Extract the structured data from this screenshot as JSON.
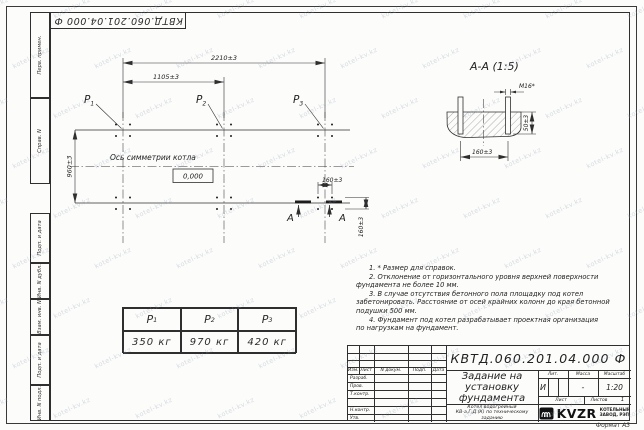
{
  "watermark": {
    "text": "kotel-kv.kz"
  },
  "frame": {
    "designation_top": "КВТД.060.201.04.000 Ф",
    "format_label": "Формат А3",
    "side_cells": [
      {
        "label": "Перв. примен."
      },
      {
        "label": "Справ. N"
      },
      {
        "label": "Подп. и дата"
      },
      {
        "label": "Инв. N дубл."
      },
      {
        "label": "Взам. инв. N"
      },
      {
        "label": "Подп. и дата"
      },
      {
        "label": "Инв. N подл."
      }
    ]
  },
  "plan": {
    "dim_total": "2210±3",
    "dim_half": "1105±3",
    "dim_depth": "960±3",
    "dim_bolt_h": "160±3",
    "dim_bolt_v": "160±3",
    "axis_label": "Ось симметрии котла",
    "level_mark": "0,000",
    "points": [
      {
        "name": "Р",
        "index": "1"
      },
      {
        "name": "Р",
        "index": "2"
      },
      {
        "name": "Р",
        "index": "3"
      }
    ],
    "cut_label": "А"
  },
  "section": {
    "title": "А-А (1:5)",
    "bolt_label": "М16*",
    "dim_width": "160±3",
    "dim_height": "50±3"
  },
  "notes": {
    "lines": [
      "1. * Размер для справок.",
      "2. Отклонение от горизонтального уровня верхней поверхности",
      "фундамента не более 10 мм.",
      "3. В случае отсутствия бетонного пола площадку под котел",
      "забетонировать. Расстояние от осей крайних колонн до края бетонной",
      "подушки 500 мм.",
      "4. Фундамент под котел разрабатывает проектная организация",
      "по нагрузкам на фундамент."
    ]
  },
  "load_table": {
    "columns": [
      {
        "name": "Р",
        "index": "1",
        "value": "350 кг"
      },
      {
        "name": "Р",
        "index": "2",
        "value": "970 кг"
      },
      {
        "name": "Р",
        "index": "3",
        "value": "420 кг"
      }
    ]
  },
  "title_block": {
    "designation": "КВТД.060.201.04.000 Ф",
    "doc_title_lines": [
      "Задание на",
      "установку",
      "фундамента"
    ],
    "product_lines": [
      "Котел водогрейный",
      "КВ-а,Г,Д (К) по техническому",
      "заданию"
    ],
    "rev_header": [
      "Изм.",
      "Лист",
      "N докум.",
      "Подп.",
      "Дата"
    ],
    "row_labels": [
      "Разраб.",
      "Пров.",
      "Т.контр.",
      "",
      "Н.контр.",
      "Утв."
    ],
    "lit_label": "Лит.",
    "mass_label": "Масса",
    "scale_label": "Масштаб",
    "lit_value": "И",
    "mass_value": "-",
    "scale_value": "1:20",
    "sheet_label": "Лист",
    "sheets_label": "Листов",
    "sheets_value": "1",
    "company": {
      "logo_text": "KVZR",
      "name_line1": "КОТЕЛЬНЫЙ",
      "name_line2": "ЗАВОД, РЭП"
    }
  }
}
